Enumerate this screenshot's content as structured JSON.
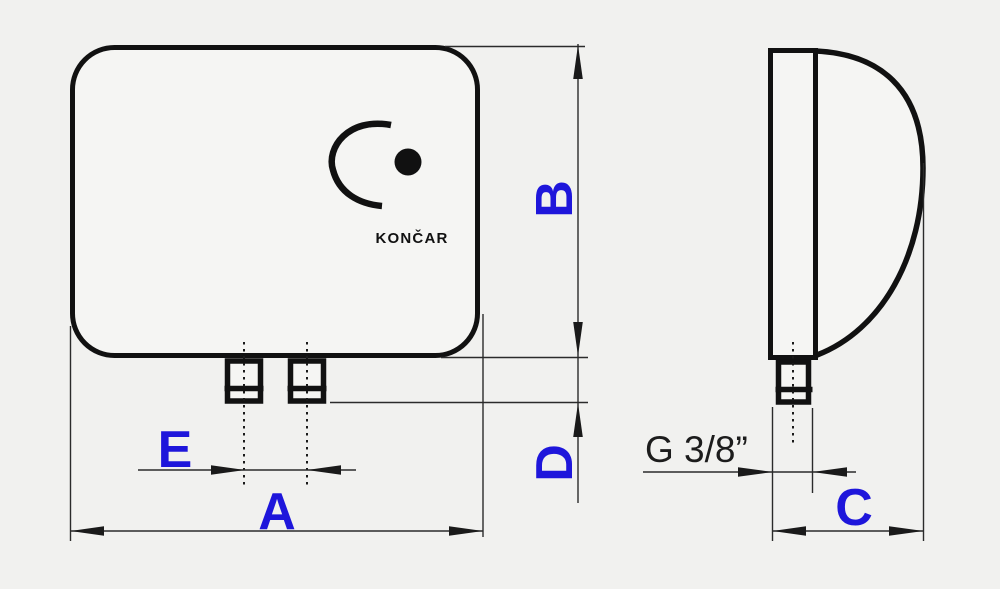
{
  "drawing": {
    "brand": "KONČAR",
    "thread_size": "G 3/8”",
    "labels": {
      "width_a": "A",
      "height_b": "B",
      "depth_c": "C",
      "pipe_protrusion_d": "D",
      "pipe_spacing_e": "E"
    },
    "colors": {
      "dimension_label": "#1e16db",
      "outline": "#111111",
      "thin_line": "#2b2b2b",
      "background": "#f1f1ef",
      "body_fill": "#f5f5f3"
    }
  }
}
